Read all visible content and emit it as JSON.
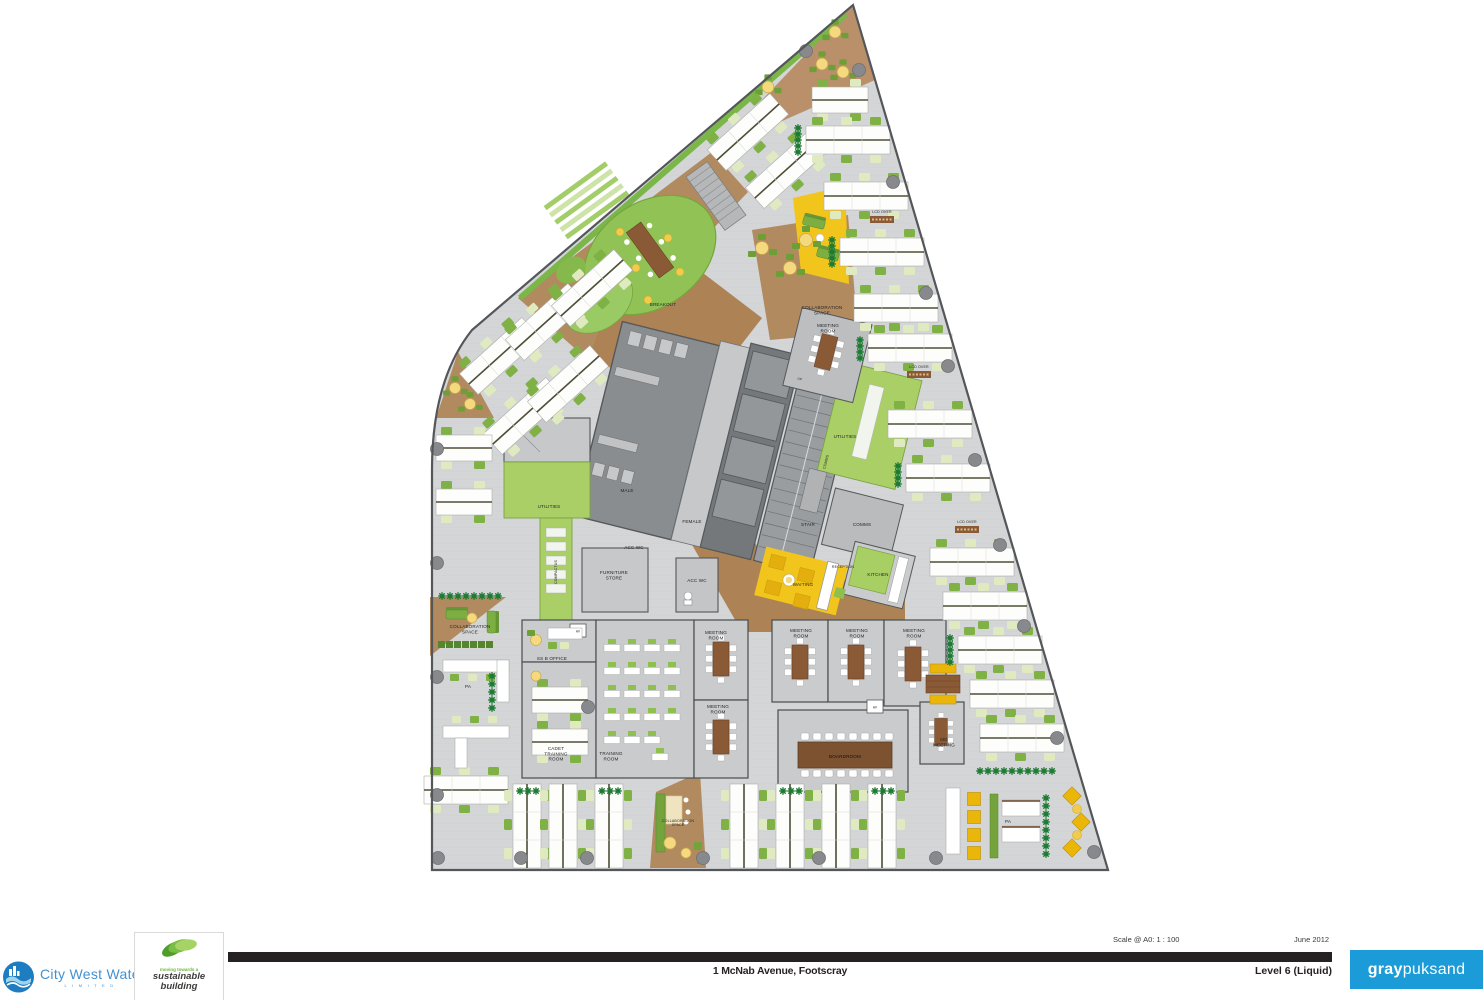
{
  "plan": {
    "rooms": {
      "breakout": "BREAKOUT",
      "collaboration_space_ne": "COLLABORATION\nSPACE",
      "meeting_room_ne": "MEETING\nROOM",
      "utilities_e": "UTILITIES",
      "comms_shaft": "COMMS",
      "stair": "STAIR",
      "comms_room": "COMMS",
      "male": "MALE",
      "female": "FEMALE",
      "acc_wc_core": "ACC WC",
      "acc_wc_entry": "ACC WC",
      "furniture_store": "FURNITURE\nSTORE",
      "compactus": "COMPACTUS",
      "utilities_w": "UTILITIES",
      "waiting": "WAITING",
      "reception": "RECEPTION",
      "kitchen": "KITCHEN",
      "collaboration_space_w": "COLLABORATION\nSPACE",
      "pa_w": "PA",
      "ss_b_office": "SS B OFFICE",
      "av_1": "AV",
      "av_2": "AV",
      "cadet_training_room": "CADET\nTRAINING\nROOM",
      "training_room": "TRAINING\nROOM",
      "meeting_room_c1": "MEETING\nROOM",
      "meeting_room_c2": "MEETING\nROOM",
      "meeting_room_e1": "MEETING\nROOM",
      "meeting_room_e2": "MEETING\nROOM",
      "meeting_room_e3": "MEETING\nROOM",
      "boardroom": "BOARDROOM",
      "md_meeting": "MD\nMEETING",
      "collaboration_space_s": "COLLABORATION\nSPACE",
      "pa_s": "PA",
      "lcd_over_1": "LCD OVER",
      "lcd_over_2": "LCD OVER",
      "lcd_over_3": "LCD OVER",
      "up": "UP"
    }
  },
  "title_block": {
    "client": {
      "name": "City West Water",
      "sub": "L I M I T E D"
    },
    "sustainability": {
      "tagline": "moving towards a",
      "line1": "sustainable",
      "line2": "building"
    },
    "scale": "Scale @ A0: 1 : 100",
    "date": "June 2012",
    "project_title": "1 McNab Avenue, Footscray",
    "sheet_title": "Level 6 (Liquid)",
    "architect": {
      "bold": "gray",
      "light": "puksand"
    }
  },
  "colors": {
    "cww_blue": "#2a84c6",
    "graypuksand_blue": "#1b9bd7",
    "titlebar_black": "#262223",
    "floor_gray": "#d3d5d7",
    "timber_brown": "#b28a5f",
    "planting_green": "#8cbf52",
    "utilities_green": "#a9cf66",
    "accent_yellow": "#f2c51d"
  }
}
